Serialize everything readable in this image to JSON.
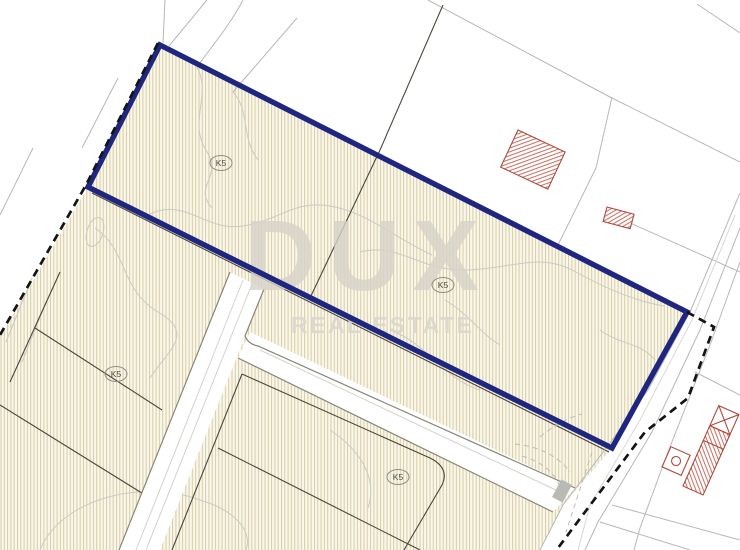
{
  "map": {
    "title": "cadastral plan with highlighted parcel",
    "watermark": {
      "line1": "DUX",
      "line2": "REAL ESTATE"
    },
    "parcel_labels": [
      {
        "text": "K5"
      },
      {
        "text": "K5"
      },
      {
        "text": "K5"
      },
      {
        "text": "K5"
      }
    ],
    "colors": {
      "parcel_highlight": "#1f2680",
      "boundary_dash": "#141414",
      "building_red": "#b0493b",
      "parcel_fill": "#f9f6ea",
      "parcel_hatch": "#d8cda6",
      "contour_gray": "#cbcac4",
      "road_gray": "#b7b7b4",
      "road_edge": "#8a8577",
      "cadastral": "#4c463c"
    }
  }
}
